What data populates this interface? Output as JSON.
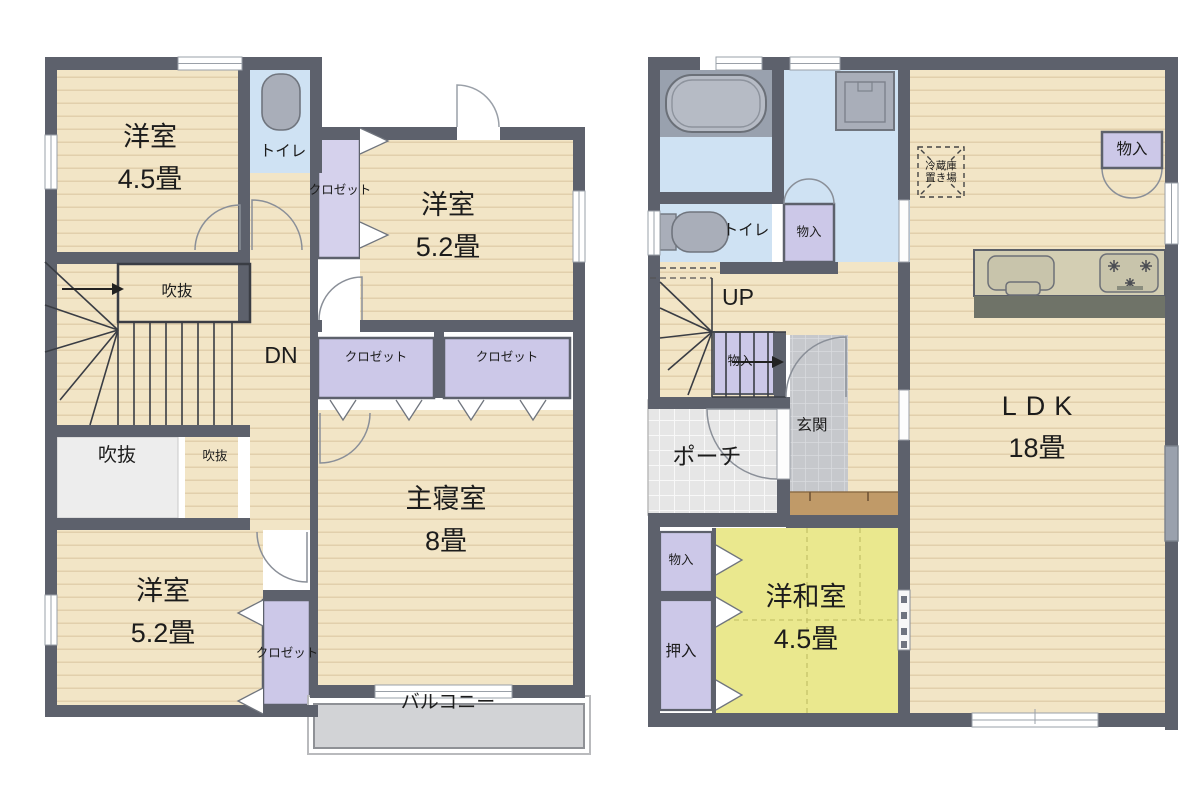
{
  "colors": {
    "wall": "#5d616c",
    "wood_floor": "#f2e5c6",
    "wet_area_floor": "#cfe2f3",
    "closet": "#ccc8e8",
    "tatami_room": "#eae88e",
    "void_area": "#ededed",
    "balcony": "#d2d3d6",
    "entrance_tile": "#c6c8cc",
    "porch_tile": "#e6e6e6",
    "step": "#c09a68",
    "fixture": "#a9aeb9",
    "text": "#1c1c1c"
  },
  "floor2": {
    "west_room_a": {
      "name": "洋室",
      "size": "4.5畳"
    },
    "toilet": {
      "name": "トイレ"
    },
    "closet_hall": {
      "name": "クロゼット"
    },
    "west_room_b": {
      "name": "洋室",
      "size": "5.2畳"
    },
    "void_over_stairs": {
      "name": "吹抜"
    },
    "down": {
      "name": "DN"
    },
    "closet_a": {
      "name": "クロゼット"
    },
    "closet_b": {
      "name": "クロゼット"
    },
    "void_large": {
      "name": "吹抜"
    },
    "void_small": {
      "name": "吹抜"
    },
    "master_bedroom": {
      "name": "主寝室",
      "size": "8畳"
    },
    "west_room_c": {
      "name": "洋室",
      "size": "5.2畳"
    },
    "closet_c": {
      "name": "クロゼット"
    },
    "balcony": {
      "name": "バルコニー"
    }
  },
  "floor1": {
    "toilet": {
      "name": "トイレ"
    },
    "storage_hall": {
      "name": "物入"
    },
    "up": {
      "name": "UP"
    },
    "storage_under_stairs": {
      "name": "物入"
    },
    "entrance": {
      "name": "玄関"
    },
    "porch": {
      "name": "ポーチ"
    },
    "fridge_space": {
      "line1": "冷蔵庫",
      "line2": "置き場"
    },
    "storage_ldk": {
      "name": "物入"
    },
    "ldk": {
      "name": "LDK",
      "size": "18畳"
    },
    "storage_tatami": {
      "name": "物入"
    },
    "oshiire": {
      "name": "押入"
    },
    "tatami_room": {
      "name": "洋和室",
      "size": "4.5畳"
    }
  }
}
